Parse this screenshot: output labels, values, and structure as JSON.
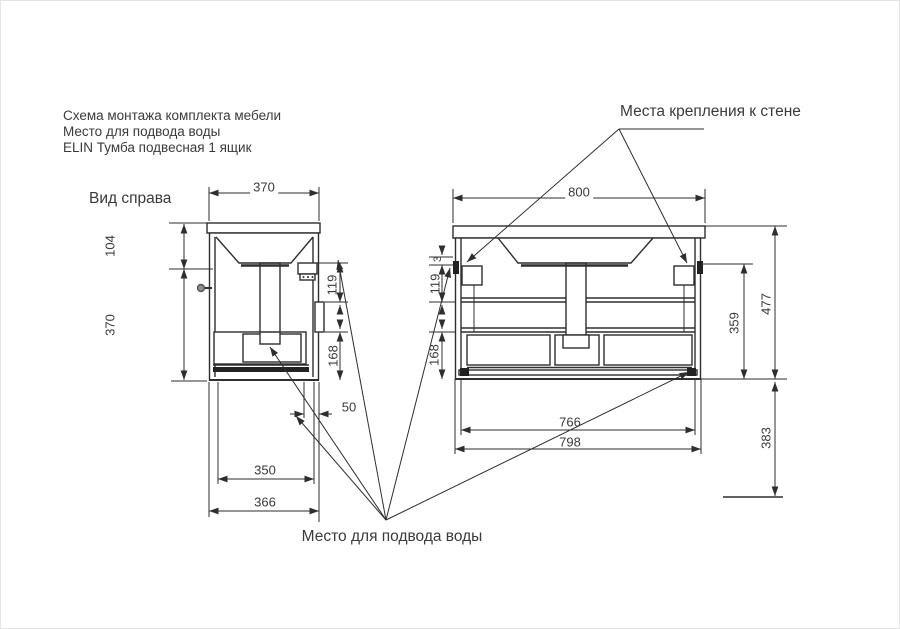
{
  "page": {
    "background": "#ffffff",
    "line_color": "#2e2e2e",
    "text_color": "#3a3a3a"
  },
  "title_block": {
    "line1": "Схема монтажа комплекта мебели",
    "line2": "Место для подвода воды",
    "line3": "ELIN Тумба подвесная 1 ящик"
  },
  "labels": {
    "side_view": "Вид справа",
    "wall_mount": "Места крепления к стене",
    "water_supply": "Место для подвода воды"
  },
  "side_view_dims": {
    "width_top": "370",
    "height_upper": "104",
    "height_lower": "370",
    "right_upper": "119",
    "right_lower": "168",
    "wall_offset": "50",
    "bottom_inner": "350",
    "bottom_outer": "366"
  },
  "front_view_dims": {
    "width_top": "800",
    "left_gap": "3",
    "left_upper": "119",
    "left_lower": "168",
    "right_bracket": "359",
    "right_total": "477",
    "right_below": "383",
    "bottom_inner": "766",
    "bottom_outer": "798"
  }
}
